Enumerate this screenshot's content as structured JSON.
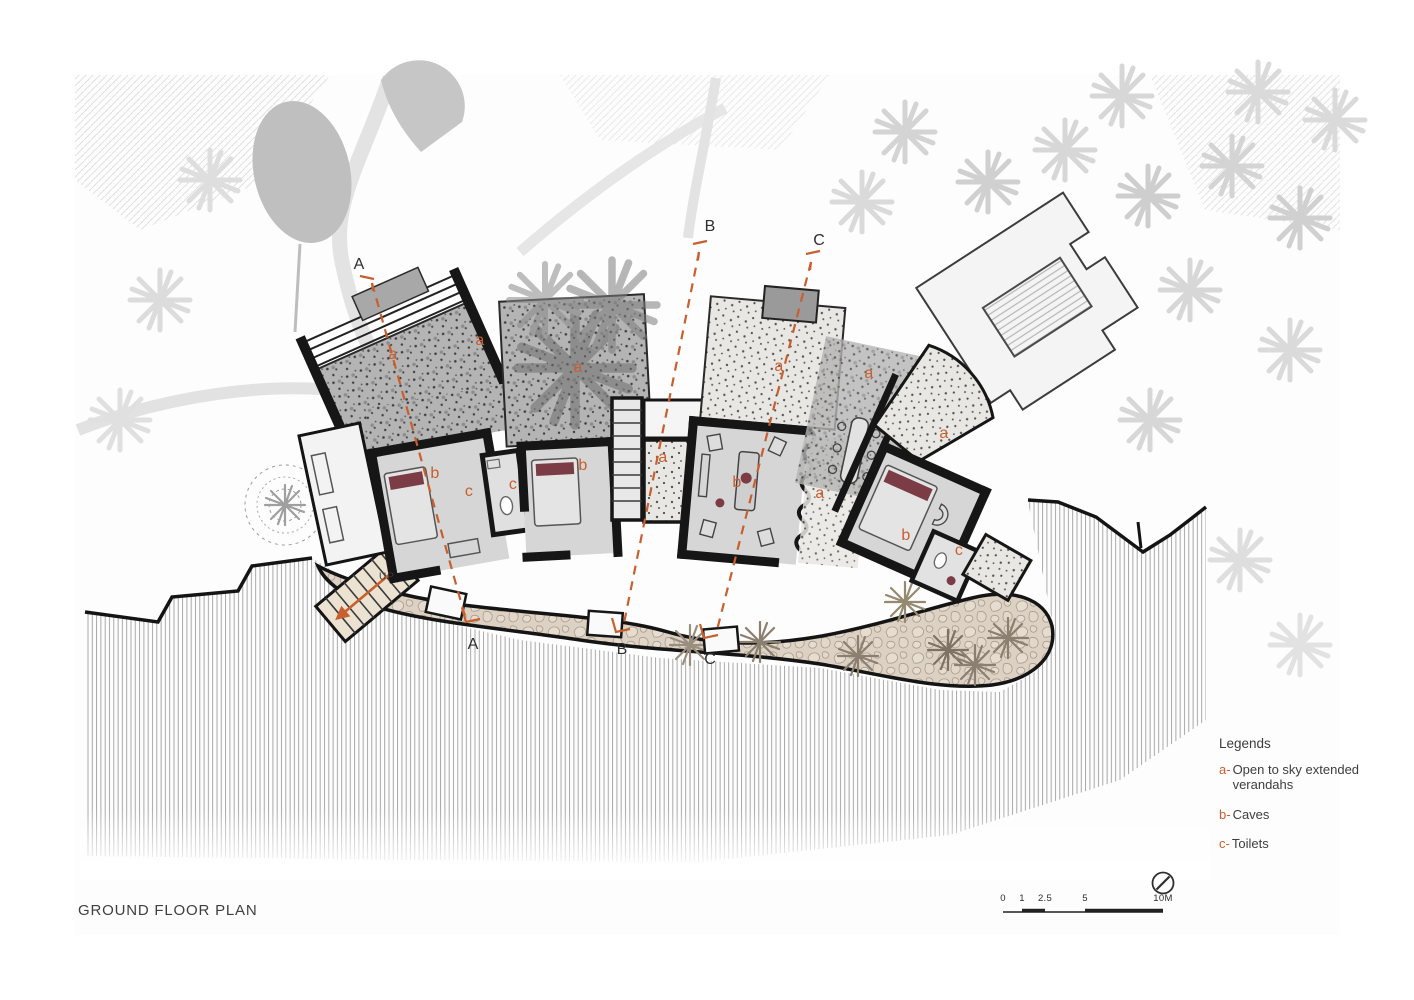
{
  "sheet": {
    "title": "GROUND FLOOR PLAN",
    "drawing_type": "architectural site / floor plan"
  },
  "legend": {
    "heading": "Legends",
    "items": [
      {
        "key": "a-",
        "label": "Open to sky extended verandahs"
      },
      {
        "key": "b-",
        "label": "Caves"
      },
      {
        "key": "c-",
        "label": "Toilets"
      }
    ]
  },
  "plan_letters": {
    "verandah": "a",
    "cave": "b",
    "toilet": "c",
    "stairs_up": "UP"
  },
  "sections": [
    {
      "label": "A"
    },
    {
      "label": "B"
    },
    {
      "label": "C"
    }
  ],
  "scale_bar": {
    "ticks": [
      "0",
      "1",
      "2.5",
      "5",
      "10M"
    ]
  },
  "icons": {
    "north_indicator": "north-arrow"
  },
  "colors": {
    "accent_orange": "#c85f2e",
    "wall_black": "#161616",
    "room_gray": "#d6d6d6",
    "path_beige": "#dcd1c3",
    "maroon_accent": "#7b3c45",
    "beach_hatch": "#9e9e9e"
  }
}
